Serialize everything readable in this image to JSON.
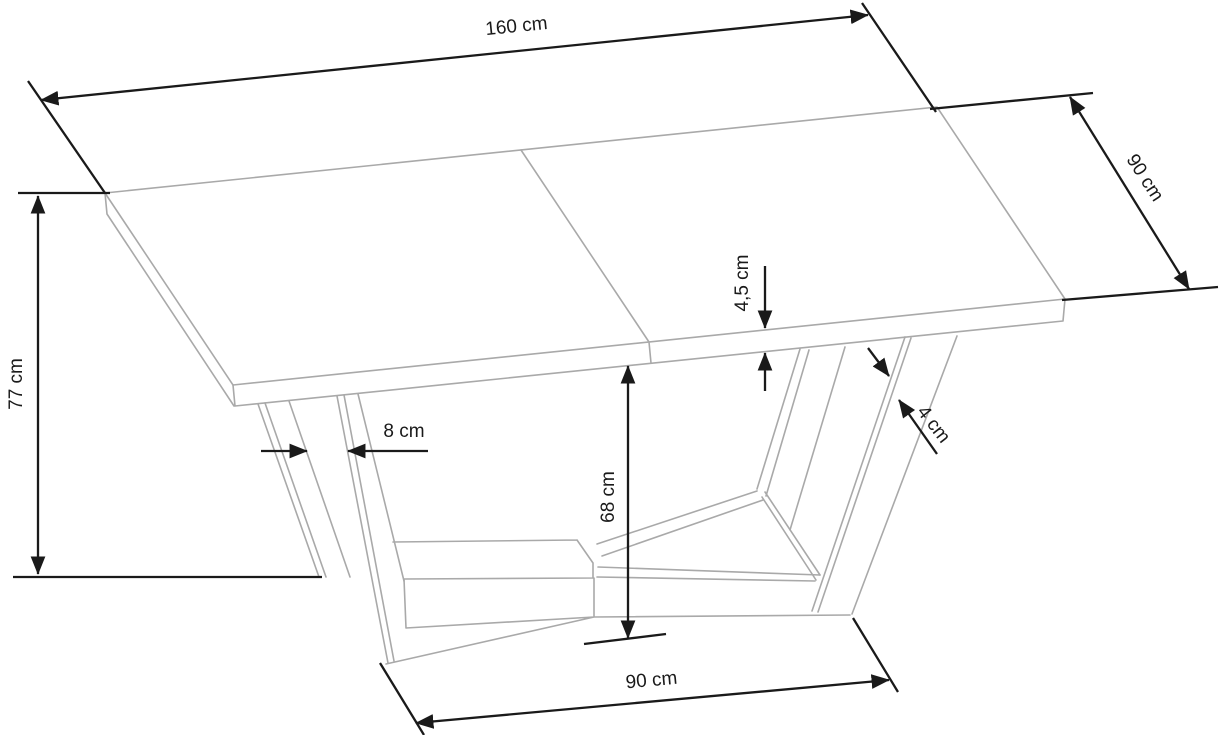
{
  "drawing": {
    "subject": "extendable dining table with V-shaped legs and X-base, dimensional technical drawing",
    "unit": "cm",
    "colors": {
      "background": "#ffffff",
      "table_outline": "#a9a9a9",
      "dimension_lines": "#1a1a1a"
    },
    "dimensions": {
      "tabletop_length": {
        "label": "160 cm",
        "value": 160
      },
      "tabletop_depth": {
        "label": "90 cm",
        "value": 90
      },
      "table_height": {
        "label": "77 cm",
        "value": 77
      },
      "tabletop_thickness": {
        "label": "4,5 cm",
        "value": 4.5
      },
      "leg_profile_thickness": {
        "label": "4 cm",
        "value": 4
      },
      "leg_spacing": {
        "label": "8 cm",
        "value": 8
      },
      "underside_clearance": {
        "label": "68 cm",
        "value": 68
      },
      "base_length": {
        "label": "90 cm",
        "value": 90
      }
    }
  }
}
